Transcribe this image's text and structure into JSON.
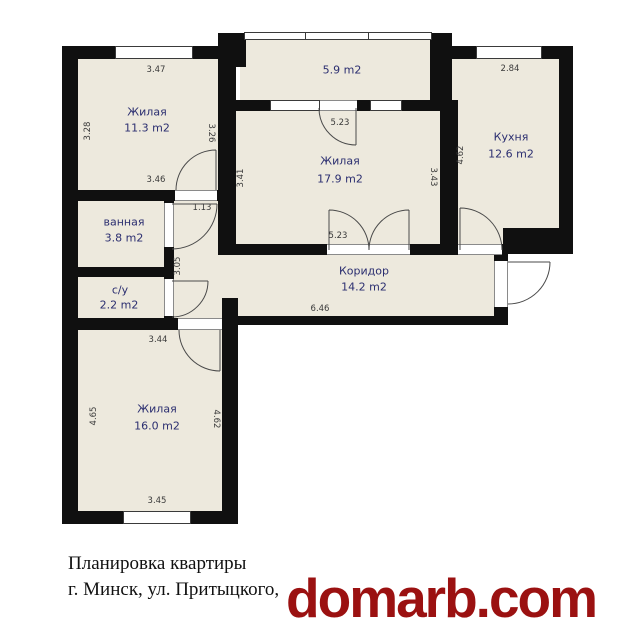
{
  "plan": {
    "rooms": [
      {
        "id": "living-1",
        "name": "Жилая",
        "area": "11.3 m2"
      },
      {
        "id": "balcony",
        "name": "",
        "area": "5.9 m2"
      },
      {
        "id": "living-2",
        "name": "Жилая",
        "area": "17.9 m2"
      },
      {
        "id": "kitchen",
        "name": "Кухня",
        "area": "12.6 m2"
      },
      {
        "id": "bathroom",
        "name": "ванная",
        "area": "3.8 m2"
      },
      {
        "id": "wc",
        "name": "с/у",
        "area": "2.2 m2"
      },
      {
        "id": "corridor",
        "name": "Коридор",
        "area": "14.2 m2"
      },
      {
        "id": "living-3",
        "name": "Жилая",
        "area": "16.0 m2"
      }
    ],
    "dimensions": {
      "room1_top": "3.47",
      "room1_left": "3.28",
      "room1_right": "3.26",
      "room1_bottom": "3.46",
      "hall_door": "1.13",
      "hall_height": "3.05",
      "room2_top": "5.23",
      "room2_left": "3.41",
      "room2_right": "3.43",
      "room2_bottom": "5.23",
      "kitchen_top": "2.84",
      "kitchen_left": "4.62",
      "corridor_length": "6.46",
      "room3_top": "3.44",
      "room3_left": "4.65",
      "room3_right": "4.62",
      "room3_bottom": "3.45"
    },
    "colors": {
      "floor": "#EDE9DD",
      "wall": "#101010",
      "room_label": "#2B2E70",
      "dimension_label": "#3A3A3A"
    }
  },
  "caption": {
    "line1": "Планировка квартиры",
    "line2": "г. Минск, ул. Притыцкого,"
  },
  "logo": {
    "text": "domarb.com",
    "color": "#9B1111"
  }
}
